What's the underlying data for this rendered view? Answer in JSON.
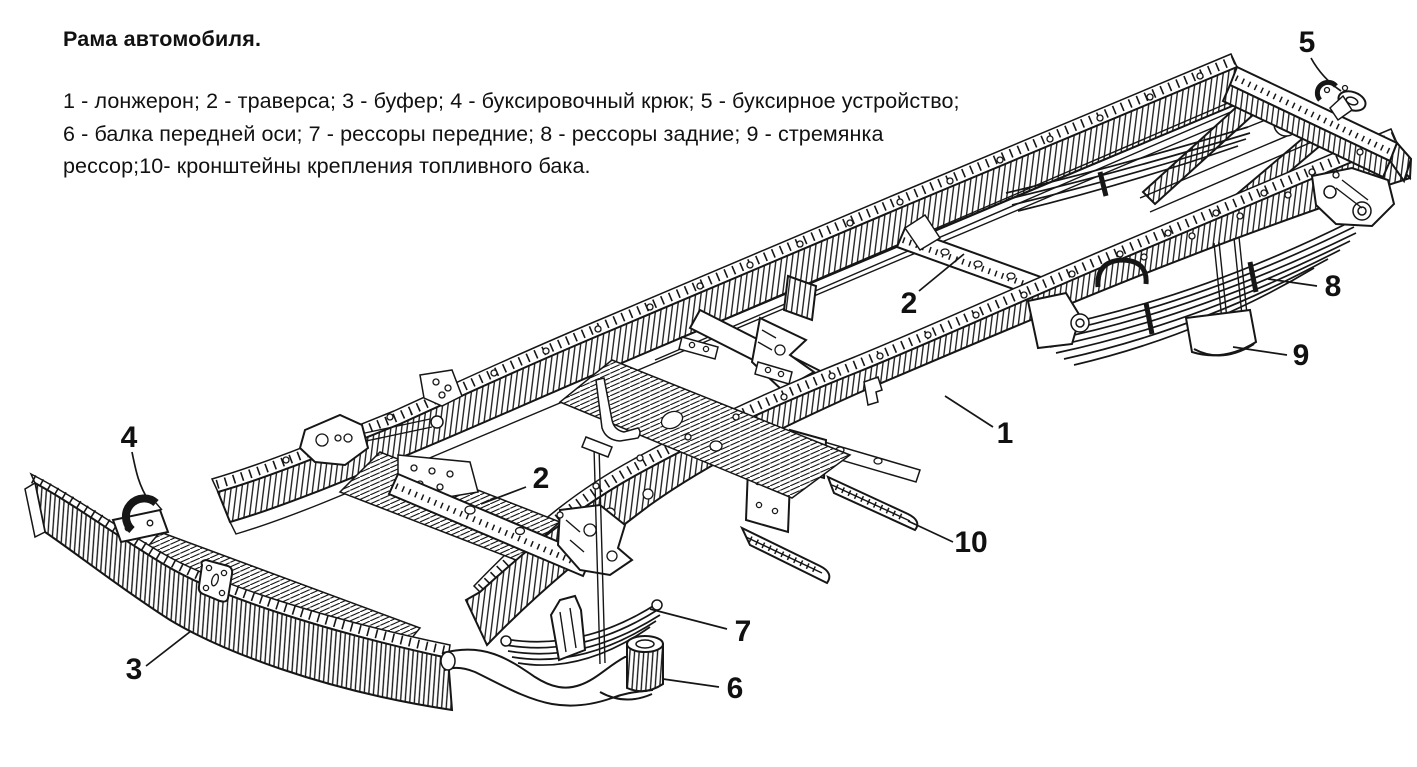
{
  "title": "Рама автомобиля.",
  "legend": {
    "lines": [
      "1 - лонжерон; 2 - траверса; 3 - буфер; 4 - буксировочный крюк; 5 - буксирное устройство;",
      "6 - балка передней оси; 7 - рессоры передние; 8 - рессоры задние; 9 - стремянка",
      "рессор;10- кронштейны крепления топливного бака."
    ],
    "items": [
      {
        "num": "1",
        "name": "лонжерон"
      },
      {
        "num": "2",
        "name": "траверса"
      },
      {
        "num": "3",
        "name": "буфер"
      },
      {
        "num": "4",
        "name": "буксировочный крюк"
      },
      {
        "num": "5",
        "name": "буксирное устройство"
      },
      {
        "num": "6",
        "name": "балка передней оси"
      },
      {
        "num": "7",
        "name": "рессоры передние"
      },
      {
        "num": "8",
        "name": "рессоры задние"
      },
      {
        "num": "9",
        "name": "стремянка рессор"
      },
      {
        "num": "10",
        "name": "кронштейны крепления топливного бака"
      }
    ]
  },
  "diagram": {
    "callouts": [
      "5",
      "8",
      "9",
      "2",
      "1",
      "4",
      "2",
      "10",
      "7",
      "6",
      "3"
    ]
  },
  "colors": {
    "background": "#ffffff",
    "ink": "#161616"
  }
}
